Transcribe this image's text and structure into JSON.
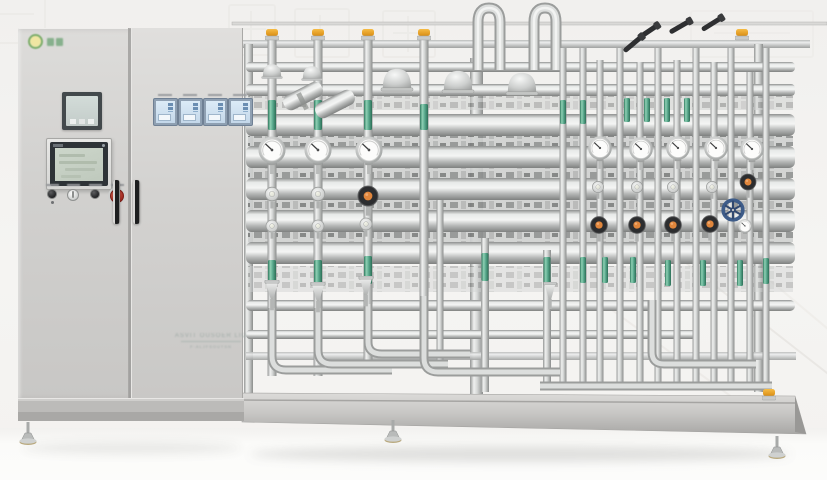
{
  "colors": {
    "wall": "#f4f3f1",
    "floor": "#fbfbfa",
    "cabinet": "#d4d3d1",
    "steel_hi": "#eff0ef",
    "steel": "#c6c8c7",
    "steel_lo": "#8f918f",
    "green_band": "#58a88c",
    "orange_cap": "#eda22f",
    "valve_orange": "#e0863c",
    "knob_black": "#2d2e30",
    "handwheel_blue": "#3d5c89",
    "estop_red": "#b8362e",
    "hmi_screen": "#c6d1c5",
    "controller_screen": "#d6e7f5",
    "controller_frame": "#8fa0b2"
  },
  "cabinet": {
    "logo": {
      "icon": "green-ring-logo-icon",
      "glyph_count": 2
    },
    "nameplate": {
      "line1": "ASVIT OUSOER LIO",
      "line2": "F·ALJFSOUTSN"
    },
    "buttons": [
      "power",
      "selector",
      "stop",
      "emergency-stop"
    ],
    "controller_count": 4
  },
  "scene": {
    "pipes": [
      [
        272,
        36,
        376,
        9
      ],
      [
        318,
        36,
        376,
        9
      ],
      [
        368,
        36,
        370,
        9
      ],
      [
        424,
        36,
        364,
        9
      ],
      [
        440,
        200,
        368,
        7
      ],
      [
        485,
        238,
        392,
        8
      ],
      [
        547,
        250,
        390,
        8
      ],
      [
        563,
        48,
        390,
        7
      ],
      [
        583,
        48,
        390,
        7
      ],
      [
        600,
        60,
        388,
        7
      ],
      [
        620,
        48,
        390,
        7
      ],
      [
        640,
        62,
        388,
        7
      ],
      [
        658,
        48,
        390,
        7
      ],
      [
        677,
        60,
        388,
        7
      ],
      [
        696,
        48,
        390,
        7
      ],
      [
        714,
        62,
        388,
        7
      ],
      [
        731,
        48,
        390,
        7
      ],
      [
        750,
        72,
        388,
        7
      ],
      [
        766,
        48,
        388,
        7
      ]
    ],
    "bands": [
      [
        272,
        100,
        30,
        8
      ],
      [
        318,
        100,
        30,
        8
      ],
      [
        368,
        100,
        30,
        8
      ],
      [
        424,
        104,
        26,
        8
      ],
      [
        563,
        100,
        24,
        6
      ],
      [
        583,
        100,
        24,
        6
      ],
      [
        627,
        98,
        24,
        6
      ],
      [
        647,
        98,
        24,
        6
      ],
      [
        667,
        98,
        24,
        6
      ],
      [
        687,
        98,
        24,
        6
      ],
      [
        272,
        260,
        28,
        8
      ],
      [
        318,
        260,
        28,
        8
      ],
      [
        368,
        256,
        28,
        8
      ],
      [
        485,
        253,
        28,
        7
      ],
      [
        547,
        257,
        28,
        7
      ],
      [
        583,
        257,
        26,
        6
      ],
      [
        605,
        257,
        26,
        6
      ],
      [
        633,
        257,
        26,
        6
      ],
      [
        668,
        260,
        26,
        6
      ],
      [
        703,
        260,
        26,
        6
      ],
      [
        740,
        260,
        26,
        6
      ],
      [
        766,
        258,
        26,
        6
      ]
    ],
    "caps": [
      [
        272,
        29
      ],
      [
        318,
        29
      ],
      [
        368,
        29
      ],
      [
        424,
        29
      ],
      [
        742,
        29
      ],
      [
        769,
        389
      ]
    ],
    "gauges": [
      [
        272,
        150,
        31
      ],
      [
        318,
        150,
        31
      ],
      [
        369,
        150,
        31
      ],
      [
        600,
        148,
        27
      ],
      [
        641,
        149,
        27
      ],
      [
        678,
        148,
        27
      ],
      [
        716,
        148,
        27
      ],
      [
        752,
        149,
        27
      ],
      [
        745,
        226,
        16
      ]
    ],
    "valves": [
      [
        272,
        194,
        17
      ],
      [
        318,
        194,
        17
      ],
      [
        272,
        226,
        15
      ],
      [
        318,
        226,
        15
      ],
      [
        366,
        224,
        15
      ],
      [
        598,
        187,
        14
      ],
      [
        637,
        187,
        14
      ],
      [
        673,
        187,
        14
      ],
      [
        712,
        187,
        14
      ]
    ],
    "knobs": [
      [
        368,
        196,
        25
      ],
      [
        599,
        225,
        21
      ],
      [
        637,
        225,
        21
      ],
      [
        673,
        225,
        21
      ],
      [
        710,
        224,
        21
      ],
      [
        748,
        182,
        20
      ]
    ],
    "wheels": [
      [
        733,
        210,
        26
      ]
    ],
    "funnels": [
      [
        272,
        280,
        19
      ],
      [
        318,
        282,
        19
      ],
      [
        366,
        276,
        19
      ],
      [
        550,
        282,
        17
      ]
    ],
    "domes": [
      [
        272,
        74,
        22
      ],
      [
        312,
        76,
        22
      ],
      [
        397,
        84,
        34
      ],
      [
        458,
        86,
        34
      ],
      [
        522,
        88,
        34
      ]
    ],
    "levers": [
      [
        649,
        31,
        -34
      ],
      [
        681,
        26,
        -30
      ],
      [
        713,
        23,
        -32
      ],
      [
        634,
        43,
        -40
      ]
    ],
    "feet": [
      [
        28,
        422
      ],
      [
        393,
        420
      ],
      [
        777,
        436
      ]
    ]
  }
}
